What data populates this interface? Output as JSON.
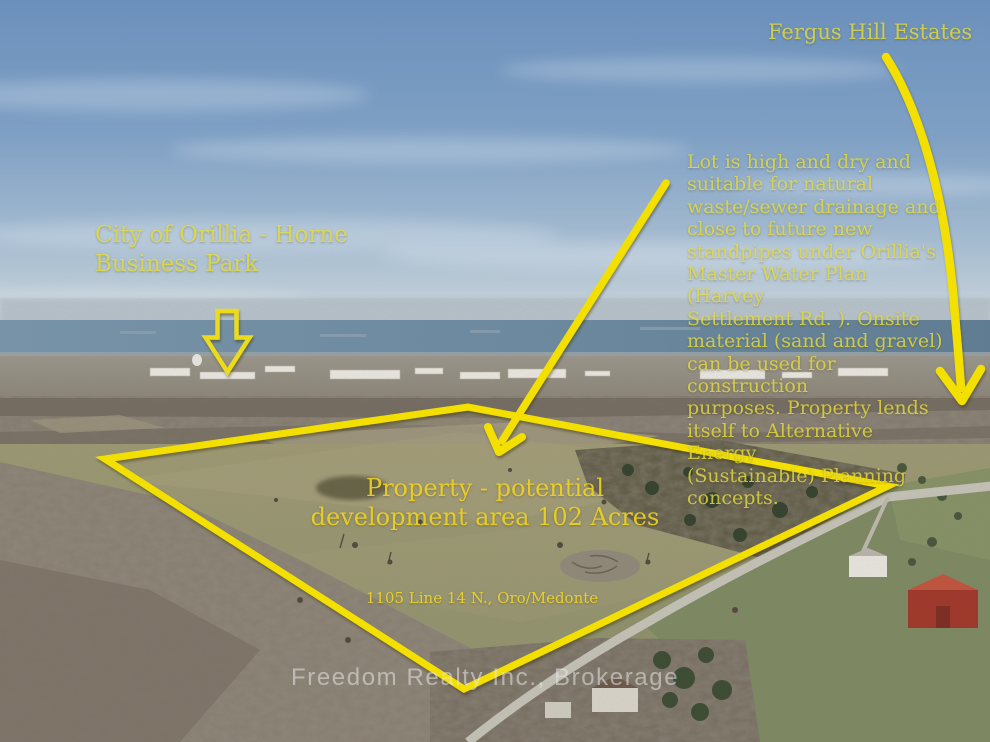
{
  "photo": {
    "description": "aerial drone view of rural vacant land listing",
    "watermark": "Freedom Realty Inc., Brokerage"
  },
  "annotations": {
    "fergus_hill": {
      "label": "Fergus Hill Estates"
    },
    "orillia_horne": {
      "label": "City of Orillia - Horne\nBusiness Park"
    },
    "lot_note": {
      "text": "Lot is high and dry and\nsuitable for natural\nwaste/sewer drainage and\nclose to future new\nstandpipes under Orillia's\nMaster Water Plan (Harvey\nSettlement Rd. ). Onsite\nmaterial (sand and gravel)\ncan be used for construction\npurposes. Property lends\nitself to Alternative Energy\n(Sustainable) Planning\nconcepts."
    },
    "property_area": {
      "label": "Property - potential\ndevelopment area 102 Acres"
    },
    "address": {
      "label": "1105 Line 14 N., Oro/Medonte"
    }
  },
  "colors": {
    "annotation_yellow": "#f4e000",
    "text_yellow_over_sky": "#cfd05a",
    "text_yellow_over_ground": "#f0d520",
    "watermark_gray": "#e8e8e8",
    "sky_blue_top": "#6b90bb",
    "lake_blue": "#6b8aa2",
    "field_green": "#98946f"
  }
}
